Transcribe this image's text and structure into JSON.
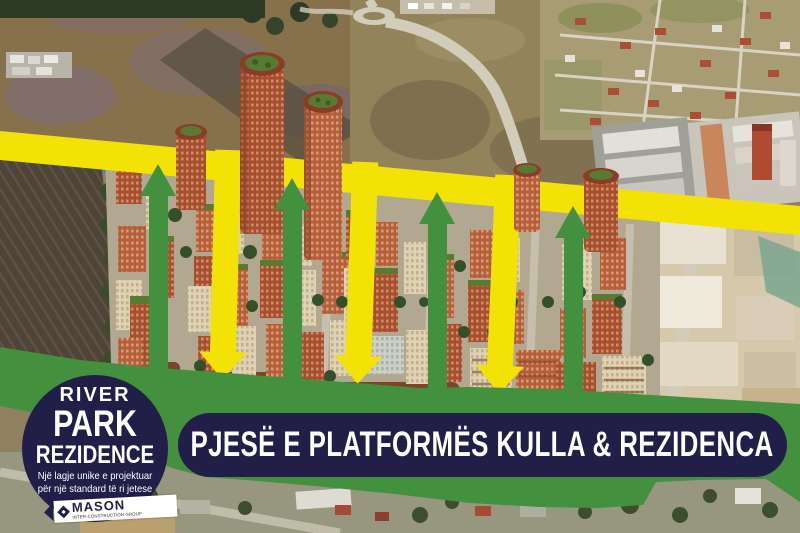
{
  "banner": {
    "title": "PJESË E PLATFORMËS KULLA & REZIDENCA"
  },
  "badge": {
    "line1": "RIVER",
    "line2": "PARK",
    "line3": "REZIDENCE",
    "tagline_line1": "Një lagje unike e projektuar",
    "tagline_line2": "për një standard të ri jetese"
  },
  "logo": {
    "name": "MASON",
    "subtitle": "INTER-CONSTRUCTION GROUP"
  },
  "colors": {
    "accent_yellow": "#f2e205",
    "accent_green": "#43903f",
    "brand_navy": "#211e48",
    "text_white": "#ffffff"
  }
}
